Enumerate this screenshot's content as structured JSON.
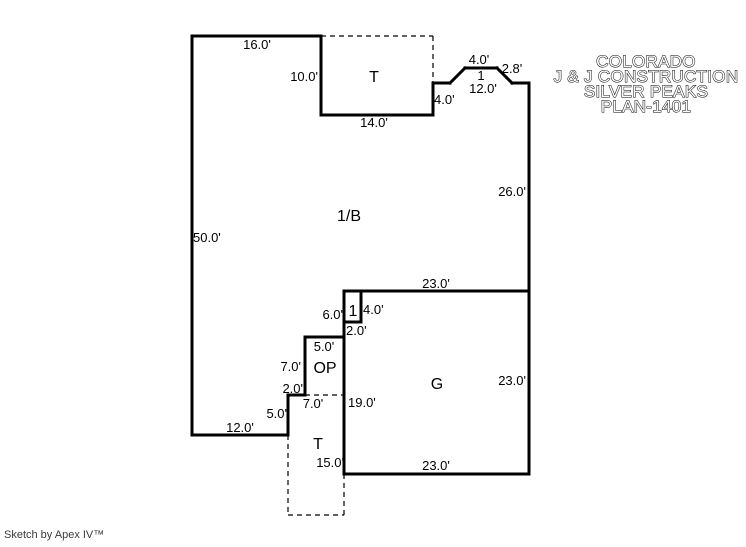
{
  "canvas": {
    "width": 746,
    "height": 547,
    "colors": {
      "background": "#ffffff",
      "line": "#000000",
      "title_fill": "#ffffff",
      "title_outline": "#000000",
      "credit_text": "#3a3a3a"
    }
  },
  "title_block": {
    "lines": [
      "COLORADO",
      "J & J CONSTRUCTION",
      "SILVER PEAKS",
      "PLAN-1401"
    ],
    "center_x": 646,
    "baselines": [
      67,
      82,
      97,
      112
    ]
  },
  "footer": {
    "credit": "Sketch by Apex IV™"
  },
  "floor_plan": {
    "room_codes": [
      "1/B",
      "T",
      "OP",
      "G",
      "T",
      "1"
    ],
    "solid_walls": [
      [
        192,
        36,
        321,
        36
      ],
      [
        321,
        36,
        321,
        115
      ],
      [
        321,
        115,
        433,
        115
      ],
      [
        433,
        115,
        433,
        83
      ],
      [
        433,
        83,
        450,
        83
      ],
      [
        450,
        83,
        465,
        68
      ],
      [
        465,
        68,
        497,
        68
      ],
      [
        497,
        68,
        512,
        83
      ],
      [
        512,
        83,
        529,
        83
      ],
      [
        529,
        83,
        529,
        474
      ],
      [
        344,
        291,
        529,
        291
      ],
      [
        361,
        291,
        361,
        322
      ],
      [
        361,
        322,
        344,
        322
      ],
      [
        344,
        291,
        344,
        474
      ],
      [
        344,
        337,
        305,
        337
      ],
      [
        305,
        337,
        305,
        395
      ],
      [
        305,
        395,
        288,
        395
      ],
      [
        288,
        395,
        288,
        435
      ],
      [
        288,
        435,
        192,
        435
      ],
      [
        192,
        435,
        192,
        36
      ],
      [
        344,
        474,
        529,
        474
      ]
    ],
    "dashed_walls": [
      [
        321,
        36,
        433,
        36
      ],
      [
        433,
        36,
        433,
        83
      ],
      [
        305,
        395,
        344,
        395
      ],
      [
        288,
        435,
        288,
        515
      ],
      [
        288,
        515,
        344,
        515
      ],
      [
        344,
        474,
        344,
        515
      ]
    ],
    "dimension_labels": [
      {
        "text": "16.0'",
        "x": 257,
        "y": 49,
        "anchor": "middle"
      },
      {
        "text": "10.0'",
        "x": 318,
        "y": 81,
        "anchor": "end"
      },
      {
        "text": "14.0'",
        "x": 374,
        "y": 127,
        "anchor": "middle"
      },
      {
        "text": "4.0'",
        "x": 479,
        "y": 64,
        "anchor": "middle"
      },
      {
        "text": "2.8'",
        "x": 512,
        "y": 73,
        "anchor": "middle"
      },
      {
        "text": "1",
        "x": 481,
        "y": 80,
        "anchor": "middle"
      },
      {
        "text": "12.0'",
        "x": 483,
        "y": 93,
        "anchor": "middle"
      },
      {
        "text": "4.0'",
        "x": 434,
        "y": 104,
        "anchor": "start"
      },
      {
        "text": "26.0'",
        "x": 526,
        "y": 196,
        "anchor": "end"
      },
      {
        "text": "50.0'",
        "x": 193,
        "y": 242,
        "anchor": "start"
      },
      {
        "text": "23.0'",
        "x": 436,
        "y": 288,
        "anchor": "middle"
      },
      {
        "text": "4.0'",
        "x": 363,
        "y": 314,
        "anchor": "start"
      },
      {
        "text": "6.0'",
        "x": 343,
        "y": 319,
        "anchor": "end"
      },
      {
        "text": "2.0'",
        "x": 346,
        "y": 335,
        "anchor": "start"
      },
      {
        "text": "5.0'",
        "x": 324,
        "y": 351,
        "anchor": "middle"
      },
      {
        "text": "7.0'",
        "x": 301,
        "y": 371,
        "anchor": "end"
      },
      {
        "text": "2.0'",
        "x": 303,
        "y": 393,
        "anchor": "end"
      },
      {
        "text": "5.0'",
        "x": 287,
        "y": 418,
        "anchor": "end"
      },
      {
        "text": "12.0'",
        "x": 240,
        "y": 432,
        "anchor": "middle"
      },
      {
        "text": "7.0'",
        "x": 313,
        "y": 408,
        "anchor": "middle"
      },
      {
        "text": "19.0'",
        "x": 348,
        "y": 407,
        "anchor": "start"
      },
      {
        "text": "15.0'",
        "x": 344,
        "y": 467,
        "anchor": "end"
      },
      {
        "text": "23.0'",
        "x": 436,
        "y": 470,
        "anchor": "middle"
      },
      {
        "text": "23.0'",
        "x": 526,
        "y": 385,
        "anchor": "end"
      }
    ],
    "area_labels": [
      {
        "text": "1/B",
        "x": 349,
        "y": 221
      },
      {
        "text": "T",
        "x": 374,
        "y": 82
      },
      {
        "text": "OP",
        "x": 325,
        "y": 373
      },
      {
        "text": "G",
        "x": 437,
        "y": 389
      },
      {
        "text": "T",
        "x": 318,
        "y": 449
      },
      {
        "text": "1",
        "x": 353,
        "y": 316
      }
    ]
  }
}
